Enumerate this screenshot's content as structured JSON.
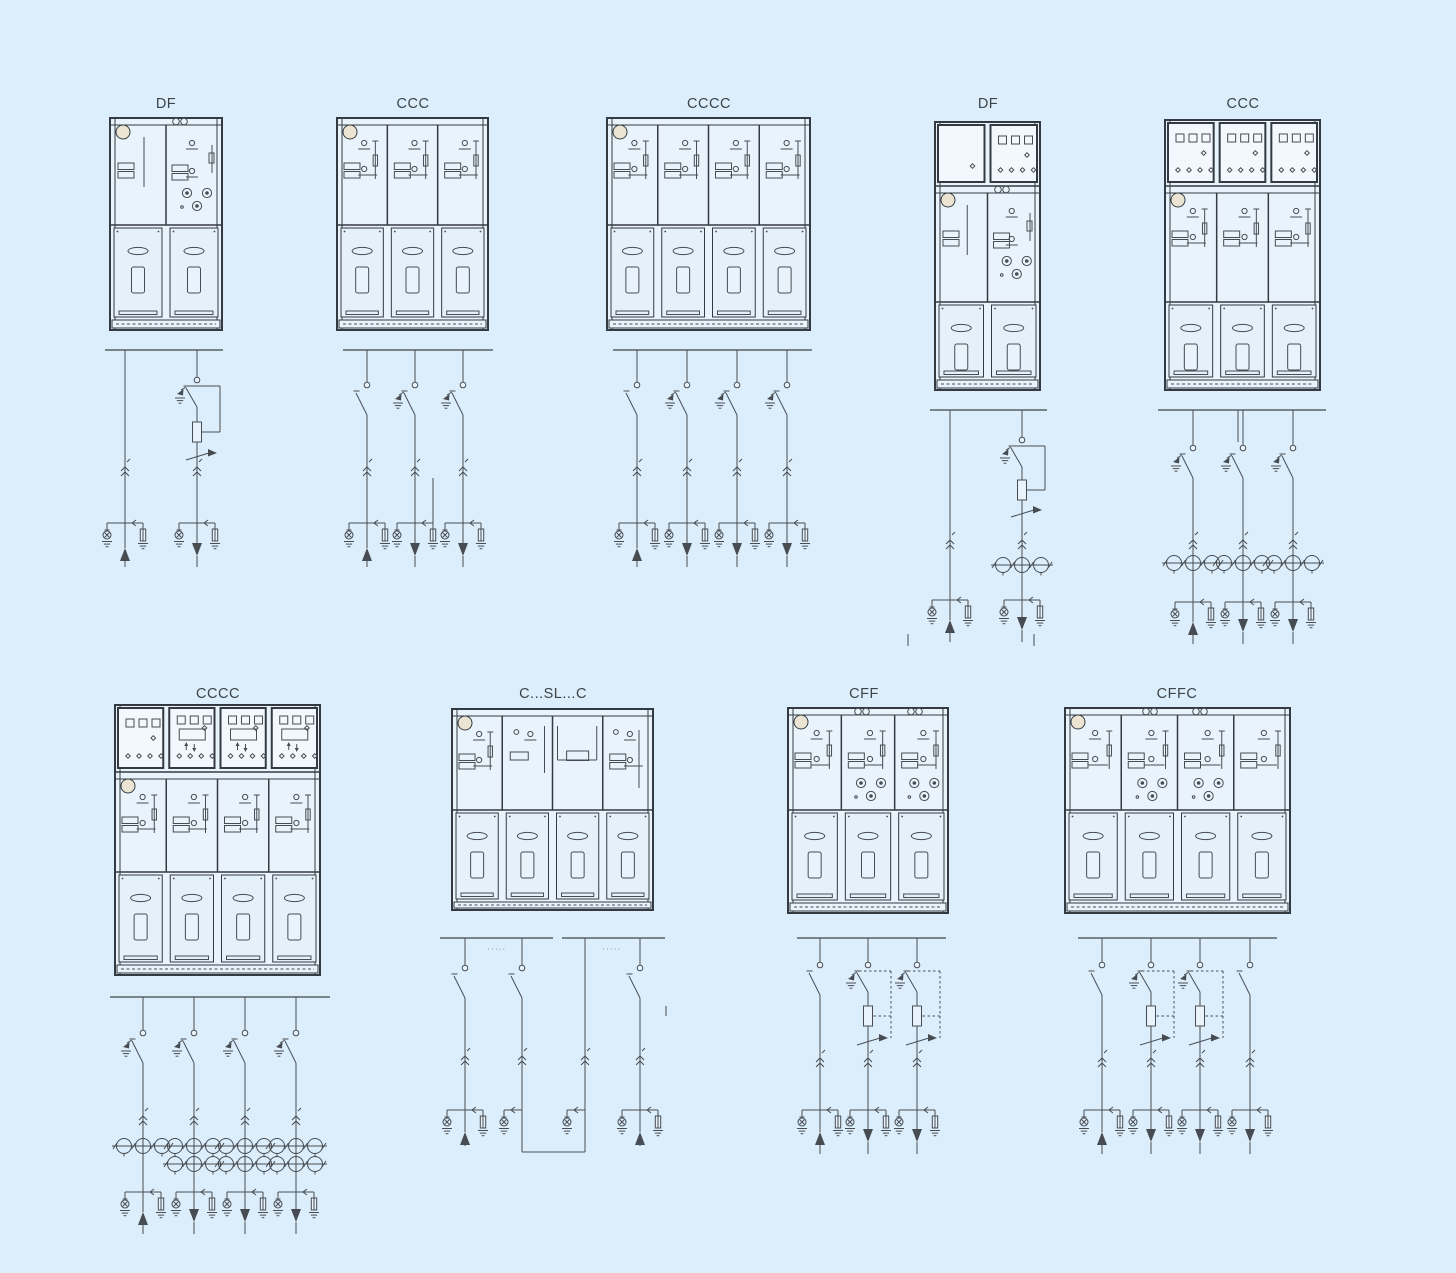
{
  "page": {
    "background_color": "#dceefb",
    "line_color": "#474c52",
    "frame_color": "#343a41",
    "bus_color": "#5a6066",
    "panel_fill": "#e9f3fc",
    "door_fill": "#e4f0fa",
    "lv_fill": "#f2f8fd",
    "knob_color": "#ece4d2",
    "label_color": "#3d4347"
  },
  "units": [
    {
      "id": "df-1",
      "label": "DF",
      "cabinet": {
        "panel_types": [
          "riser-panel",
          "switch-fuse-panel"
        ],
        "door_count": 2,
        "pressure_gauge": true,
        "roof_indicators": 1,
        "lv_compartments": []
      },
      "diagram": {
        "bus_sections": 1,
        "feeders": [
          {
            "kind": "incoming-line",
            "arrow": "up",
            "cable_test_point": true,
            "earth_indicator": true,
            "surge_arrester": true
          },
          {
            "kind": "switch-fuse-combination",
            "linkage": "solid",
            "earth_switch": true,
            "arrow": "down",
            "cable_test_point": true,
            "earth_indicator": true,
            "surge_arrester": true
          }
        ]
      }
    },
    {
      "id": "ccc-1",
      "label": "CCC",
      "cabinet": {
        "panel_types": [
          "load-break-switch-panel",
          "load-break-switch-panel",
          "load-break-switch-panel"
        ],
        "door_count": 3,
        "pressure_gauge": true,
        "roof_indicators": 0,
        "lv_compartments": []
      },
      "diagram": {
        "bus_sections": 1,
        "feeders": [
          {
            "kind": "switch",
            "arrow": "up"
          },
          {
            "kind": "earthed-switch",
            "arrow": "down",
            "cable_riser": true
          },
          {
            "kind": "earthed-switch",
            "arrow": "down"
          }
        ]
      }
    },
    {
      "id": "cccc-1",
      "label": "CCCC",
      "cabinet": {
        "panel_types": [
          "load-break-switch-panel",
          "load-break-switch-panel",
          "load-break-switch-panel",
          "load-break-switch-panel"
        ],
        "door_count": 4,
        "pressure_gauge": true,
        "roof_indicators": 0,
        "lv_compartments": []
      },
      "diagram": {
        "bus_sections": 1,
        "feeders": [
          {
            "kind": "switch",
            "arrow": "up"
          },
          {
            "kind": "earthed-switch",
            "arrow": "down"
          },
          {
            "kind": "earthed-switch",
            "arrow": "down"
          },
          {
            "kind": "earthed-switch",
            "arrow": "down"
          }
        ]
      }
    },
    {
      "id": "df-2",
      "label": "DF",
      "cabinet": {
        "panel_types": [
          "riser-panel",
          "switch-fuse-panel"
        ],
        "door_count": 2,
        "pressure_gauge": true,
        "roof_indicators": 1,
        "lv_compartments": [
          "blank-box",
          "indicator-box"
        ]
      },
      "diagram": {
        "bus_sections": 1,
        "phase_marks": 2,
        "feeders": [
          {
            "kind": "incoming-line",
            "arrow": "up"
          },
          {
            "kind": "switch-fuse-combination",
            "linkage": "solid",
            "earth_switch": true,
            "arrow": "down",
            "ct_count": 3
          }
        ]
      }
    },
    {
      "id": "ccc-2",
      "label": "CCC",
      "cabinet": {
        "panel_types": [
          "load-break-switch-panel",
          "load-break-switch-panel",
          "load-break-switch-panel"
        ],
        "door_count": 3,
        "pressure_gauge": true,
        "roof_indicators": 0,
        "lv_compartments": [
          "indicator-box",
          "indicator-box",
          "indicator-box"
        ]
      },
      "diagram": {
        "bus_sections": 1,
        "feeders": [
          {
            "kind": "earthed-switch",
            "arrow": "up",
            "ct_count": 3
          },
          {
            "kind": "earthed-switch",
            "arrow": "down",
            "ct_count": 3,
            "pt_tap": true
          },
          {
            "kind": "earthed-switch",
            "arrow": "down",
            "ct_count": 3
          }
        ]
      }
    },
    {
      "id": "cccc-2",
      "label": "CCCC",
      "cabinet": {
        "panel_types": [
          "load-break-switch-panel",
          "load-break-switch-panel",
          "load-break-switch-panel",
          "load-break-switch-panel"
        ],
        "door_count": 4,
        "pressure_gauge": true,
        "roof_indicators": 0,
        "lv_compartments": [
          "indicator-box",
          "meter-box",
          "meter-box",
          "meter-box"
        ]
      },
      "diagram": {
        "bus_sections": 1,
        "feeders": [
          {
            "kind": "earthed-switch",
            "arrow": "up",
            "ct_count": 3
          },
          {
            "kind": "earthed-switch",
            "arrow": "down",
            "ct_count": 6
          },
          {
            "kind": "earthed-switch",
            "arrow": "down",
            "ct_count": 6
          },
          {
            "kind": "earthed-switch",
            "arrow": "down",
            "ct_count": 6
          }
        ]
      }
    },
    {
      "id": "c-sl-c",
      "label": "C...SL...C",
      "cabinet": {
        "panel_types": [
          "load-break-switch-panel",
          "disconnector-panel",
          "bus-link-panel",
          "load-break-switch-panel"
        ],
        "door_count": 4,
        "pressure_gauge": true,
        "roof_indicators": 0,
        "lv_compartments": []
      },
      "diagram": {
        "bus_sections": 2,
        "bus_labels": [
          "·····",
          "·····"
        ],
        "cable_link_loop": true,
        "feeders": [
          {
            "kind": "switch",
            "arrow": "up"
          },
          {
            "kind": "switch",
            "arrow": "cable-loop"
          },
          {
            "kind": "cable-riser",
            "arrow": "cable-loop"
          },
          {
            "kind": "switch",
            "arrow": "up"
          }
        ]
      }
    },
    {
      "id": "cff",
      "label": "CFF",
      "cabinet": {
        "panel_types": [
          "load-break-switch-panel",
          "switch-fuse-panel",
          "switch-fuse-panel"
        ],
        "door_count": 3,
        "pressure_gauge": true,
        "roof_indicators": 2,
        "lv_compartments": []
      },
      "diagram": {
        "bus_sections": 1,
        "feeders": [
          {
            "kind": "switch",
            "arrow": "up"
          },
          {
            "kind": "switch-fuse-combination",
            "linkage": "dashed",
            "earth_switch": true,
            "arrow": "down"
          },
          {
            "kind": "switch-fuse-combination",
            "linkage": "dashed",
            "earth_switch": true,
            "arrow": "down"
          }
        ]
      }
    },
    {
      "id": "cffc",
      "label": "CFFC",
      "cabinet": {
        "panel_types": [
          "load-break-switch-panel",
          "switch-fuse-panel",
          "switch-fuse-panel",
          "load-break-switch-panel"
        ],
        "door_count": 4,
        "pressure_gauge": true,
        "roof_indicators": 2,
        "lv_compartments": []
      },
      "diagram": {
        "bus_sections": 1,
        "feeders": [
          {
            "kind": "switch",
            "arrow": "up"
          },
          {
            "kind": "switch-fuse-combination",
            "linkage": "dashed",
            "earth_switch": true,
            "arrow": "down"
          },
          {
            "kind": "switch-fuse-combination",
            "linkage": "dashed",
            "earth_switch": true,
            "arrow": "down"
          },
          {
            "kind": "switch",
            "arrow": "down"
          }
        ]
      }
    }
  ]
}
